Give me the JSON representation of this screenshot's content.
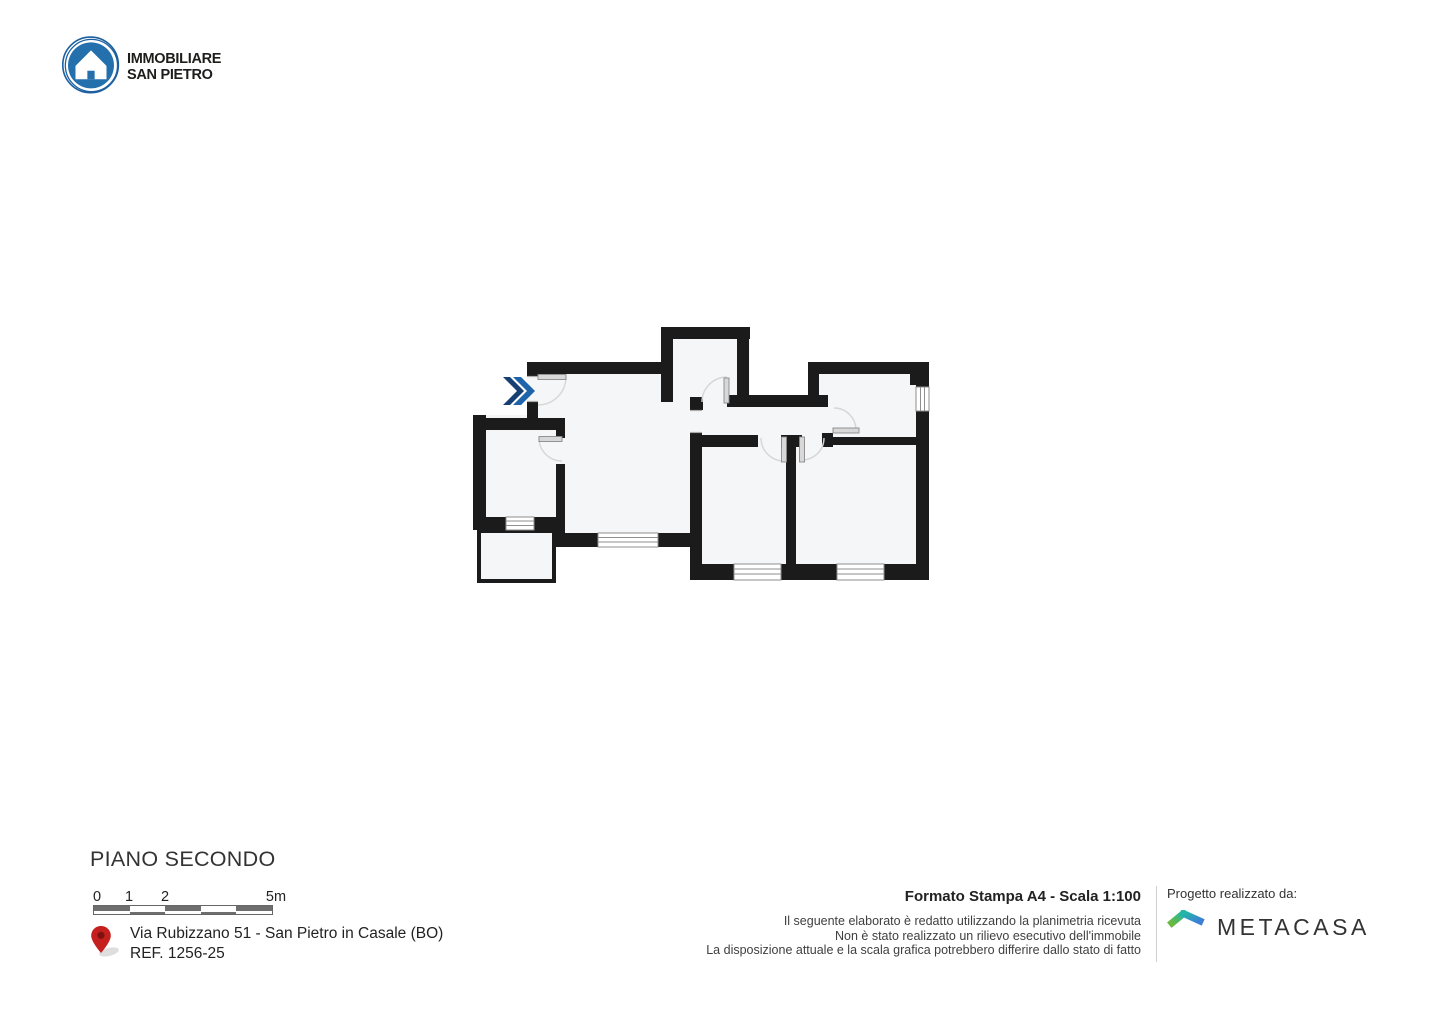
{
  "header": {
    "agency_line1": "IMMOBILIARE",
    "agency_line2": "SAN PIETRO"
  },
  "plan": {
    "floor_title": "PIANO SECONDO"
  },
  "scale_bar": {
    "labels": [
      "0",
      "1",
      "2",
      "5m"
    ]
  },
  "location": {
    "address": "Via Rubizzano 51 - San Pietro in Casale (BO)",
    "reference": "REF. 1256-25"
  },
  "print_info": {
    "format_scale": "Formato Stampa A4 - Scala 1:100",
    "disclaimers": [
      "Il seguente elaborato è redatto utilizzando la planimetria ricevuta",
      "Non è stato realizzato un rilievo esecutivo dell'immobile",
      "La disposizione attuale e la scala grafica potrebbero differire dallo stato di fatto"
    ]
  },
  "credits": {
    "label": "Progetto realizzato da:",
    "brand_name": "METACASA"
  },
  "colors": {
    "plan_wall": "#1b1b1b",
    "plan_room_fill": "#f5f6f7",
    "entrance_arrow_blue": "#1d64ab",
    "entrance_arrow_navy": "#163f73",
    "agency_logo_blue": "#2470ad",
    "pin_red": "#c5201d",
    "scale_bar_gray": "#6e6e6e",
    "door_arc_gray": "#d6d6d6",
    "door_leaf_gray": "#d8d8d8"
  }
}
